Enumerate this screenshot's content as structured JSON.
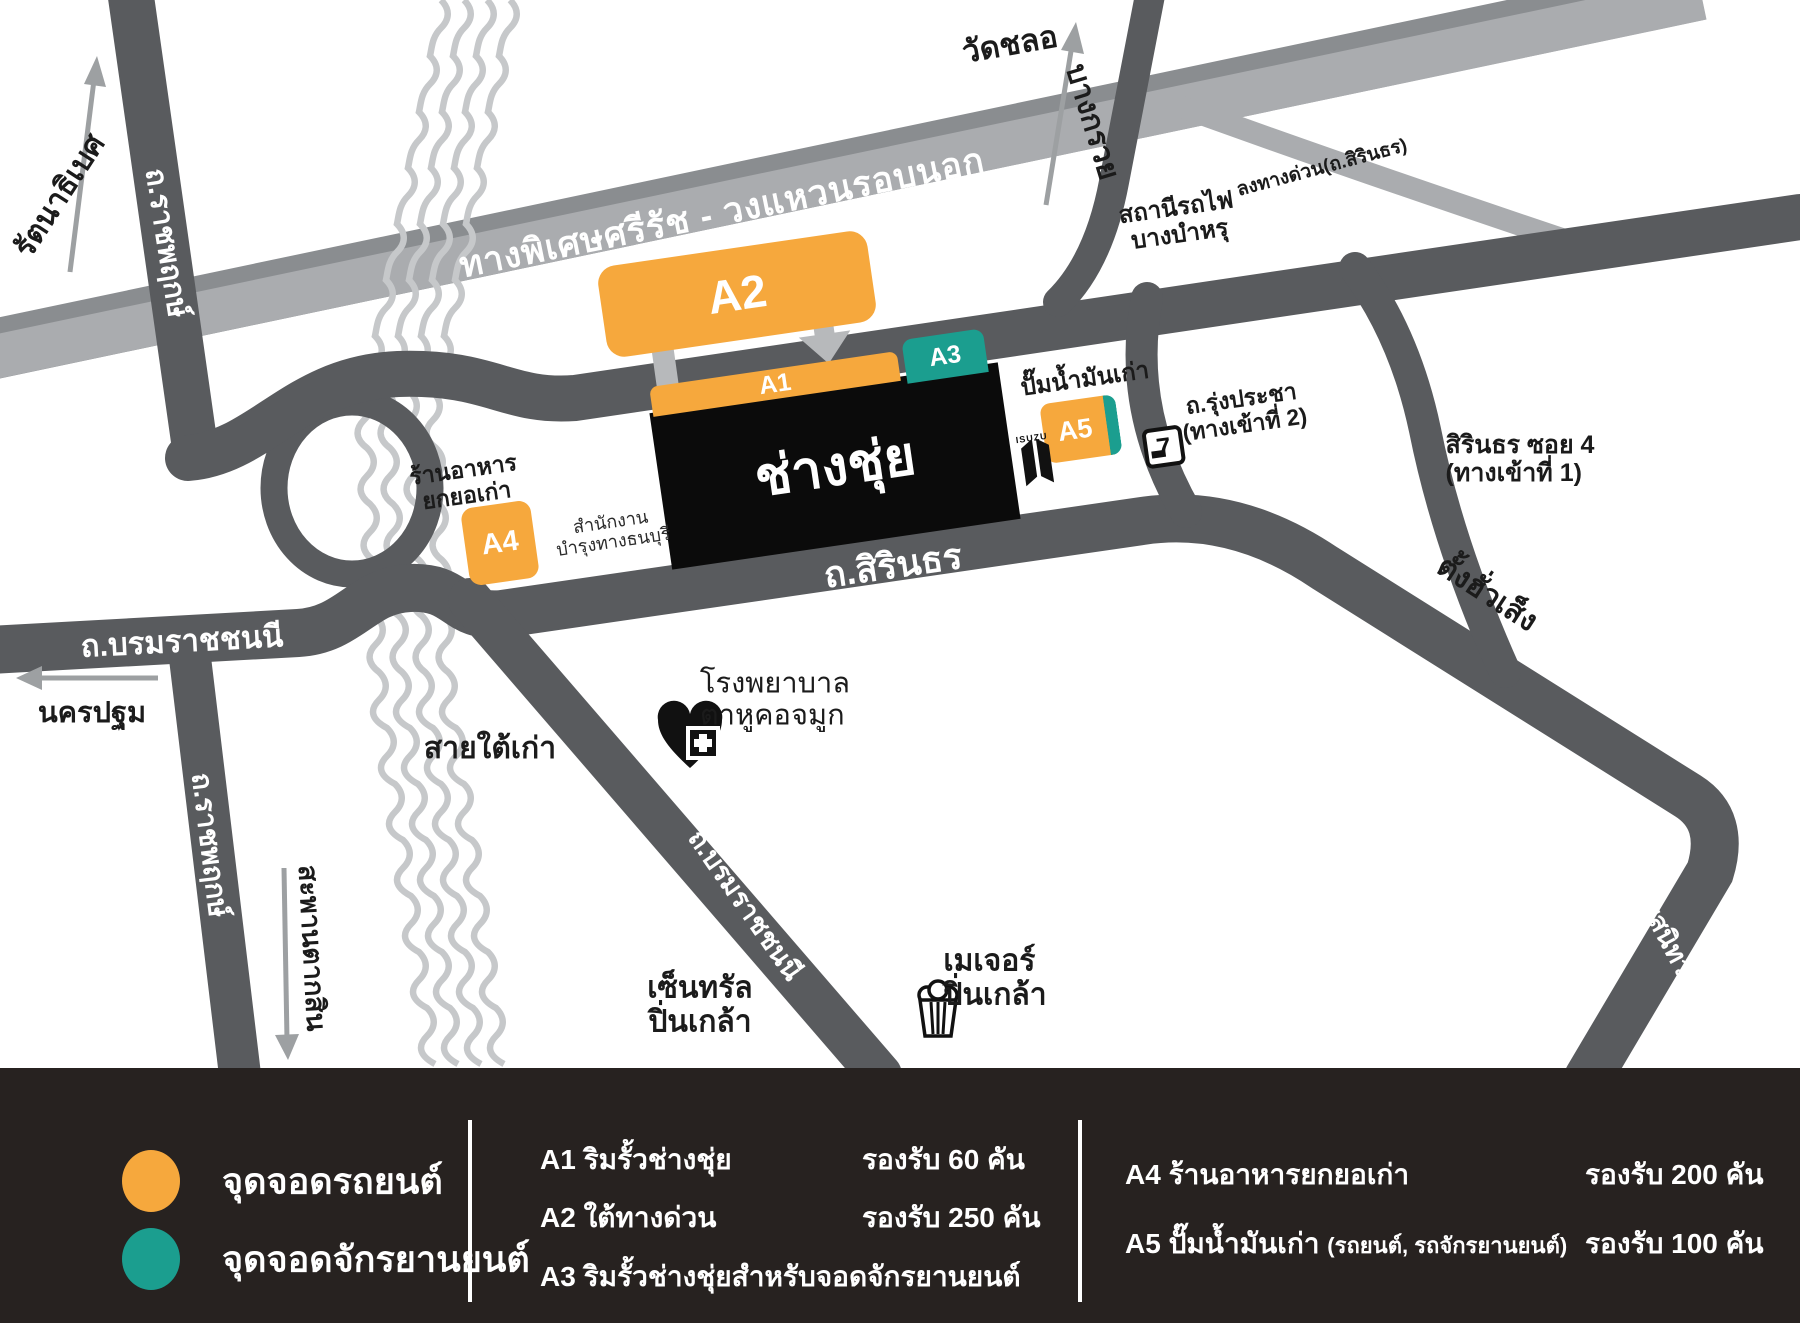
{
  "map": {
    "expressway": "ทางพิเศษศรีรัช - วงแหวนรอบนอก",
    "exit_ramp": "ลงทางด่วน(ถ.สิรินธร)",
    "road_ratchaphruek_north": "ถ.ราชพฤกษ์",
    "road_ratchaphruek_south": "ถ.ราชพฤกษ์",
    "road_borom_west": "ถ.บรมราชชนนี",
    "road_borom_diagonal": "ถ.บรมราชชนนี",
    "road_sirindhorn": "ถ.สิรินธร",
    "road_charan": "ถ.จรัญสนิทวงศ์",
    "dir_rattanathibet": "รัตนาธิเบศ",
    "dir_wat_chalo": "วัดชลอ",
    "dir_bang_kruai": "บางกรวย",
    "dir_nakhon_pathom": "นครปฐม",
    "dir_saphan_taksin": "สะพานตากสิน",
    "dir_tang_hua_seng": "ตั้งฮั่วเส็ง",
    "label_sai_tai_kao": "สายใต้เก่า",
    "station_line1": "สถานีรถไฟ",
    "station_line2": "บางบำหรุ",
    "rung_pracha_line1": "ถ.รุ่งประชา",
    "rung_pracha_line2": "(ทางเข้าที่ 2)",
    "soi4_line1": "สิรินธร ซอย 4",
    "soi4_line2": "(ทางเข้าที่ 1)",
    "gas_station": "ปั๊มน้ำมันเก่า",
    "restaurant_line1": "ร้านอาหาร",
    "restaurant_line2": "ยกยอเก่า",
    "office_line1": "สำนักงาน",
    "office_line2": "บำรุงทางธนบุรี",
    "hospital_line1": "โรงพยาบาล",
    "hospital_line2": "ตาหูคอจมูก",
    "central_line1": "เซ็นทรัล",
    "central_line2": "ปิ่นเกล้า",
    "major_line1": "เมเจอร์",
    "major_line2": "ปิ่นเกล้า",
    "logo": "ช่างชุ่ย",
    "marker_a1": "A1",
    "marker_a2": "A2",
    "marker_a3": "A3",
    "marker_a4": "A4",
    "marker_a5": "A5",
    "isuzu": "ISUZU",
    "seven": "7"
  },
  "legend": {
    "car_label": "จุดจอดรถยนต์",
    "bike_label": "จุดจอดจักรยานยนต์",
    "left_rows": [
      {
        "code": "A1",
        "name": "ริมรั้วช่างชุ่ย",
        "capacity": "รองรับ 60 คัน"
      },
      {
        "code": "A2",
        "name": "ใต้ทางด่วน",
        "capacity": "รองรับ 250 คัน"
      },
      {
        "code": "A3",
        "name": "ริมรั้วช่างชุ่ยสำหรับจอดจักรยานยนต์",
        "capacity": ""
      }
    ],
    "right_rows": [
      {
        "code": "A4",
        "name": "ร้านอาหารยกยอเก่า",
        "note": "",
        "capacity": "รองรับ 200 คัน"
      },
      {
        "code": "A5",
        "name": "ปั๊มน้ำมันเก่า",
        "note": "(รถยนต์, รถจักรยานยนต์)",
        "capacity": "รองรับ 100 คัน"
      }
    ]
  },
  "colors": {
    "car_parking": "#F6A83D",
    "bike_parking": "#1B9E8F",
    "road_dark": "#595B5E",
    "expressway": "#A9ABAE",
    "canal": "#C6C8CA",
    "legend_bg": "#272220"
  }
}
